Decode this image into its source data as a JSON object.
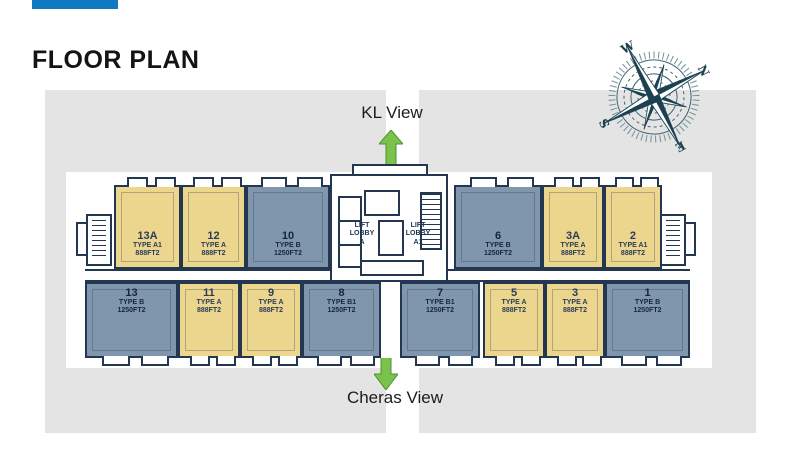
{
  "slide": {
    "title": "FLOOR PLAN"
  },
  "colors": {
    "accent": "#0f7ac1",
    "backdrop": "#e5e4e4",
    "wall": "#233750",
    "type_a_fill": "#ecd58c",
    "type_b_fill": "#8096ac",
    "arrow": "#7bc24d",
    "arrow_border": "#4e8f31",
    "compass": "#1b4252"
  },
  "views": {
    "top_label": "KL View",
    "bottom_label": "Cheras View"
  },
  "compass": {
    "cardinals": [
      "N",
      "E",
      "S",
      "W"
    ],
    "rotation_deg": 62
  },
  "plan": {
    "lift_lobby_a": "LIFT\nLOBBY\nA",
    "lift_lobby_a1": "LIFT\nLOBBY\nA1",
    "top_row": [
      {
        "no": "13A",
        "type": "TYPE A1",
        "size": "888FT2",
        "cat": "A",
        "x": 114,
        "w": 67
      },
      {
        "no": "12",
        "type": "TYPE A",
        "size": "888FT2",
        "cat": "A",
        "x": 181,
        "w": 65
      },
      {
        "no": "10",
        "type": "TYPE B",
        "size": "1250FT2",
        "cat": "B",
        "x": 246,
        "w": 84
      },
      {
        "no": "6",
        "type": "TYPE B",
        "size": "1250FT2",
        "cat": "B",
        "x": 454,
        "w": 88
      },
      {
        "no": "3A",
        "type": "TYPE A",
        "size": "888FT2",
        "cat": "A",
        "x": 542,
        "w": 62
      },
      {
        "no": "2",
        "type": "TYPE A1",
        "size": "888FT2",
        "cat": "A",
        "x": 604,
        "w": 58
      }
    ],
    "bottom_row": [
      {
        "no": "13",
        "type": "TYPE B",
        "size": "1250FT2",
        "cat": "B",
        "x": 85,
        "w": 93
      },
      {
        "no": "11",
        "type": "TYPE A",
        "size": "888FT2",
        "cat": "A",
        "x": 178,
        "w": 62
      },
      {
        "no": "9",
        "type": "TYPE A",
        "size": "888FT2",
        "cat": "A",
        "x": 240,
        "w": 62
      },
      {
        "no": "8",
        "type": "TYPE B1",
        "size": "1250FT2",
        "cat": "B",
        "x": 302,
        "w": 79
      },
      {
        "no": "7",
        "type": "TYPE B1",
        "size": "1250FT2",
        "cat": "B",
        "x": 400,
        "w": 80
      },
      {
        "no": "5",
        "type": "TYPE A",
        "size": "888FT2",
        "cat": "A",
        "x": 483,
        "w": 62
      },
      {
        "no": "3",
        "type": "TYPE A",
        "size": "888FT2",
        "cat": "A",
        "x": 545,
        "w": 60
      },
      {
        "no": "1",
        "type": "TYPE B",
        "size": "1250FT2",
        "cat": "B",
        "x": 605,
        "w": 85
      }
    ]
  }
}
